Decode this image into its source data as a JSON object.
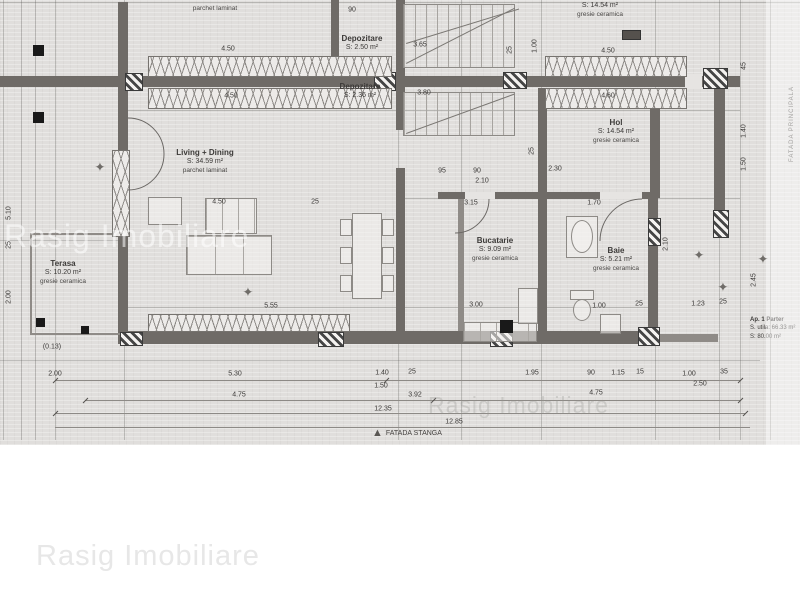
{
  "watermark": {
    "text": "Rasig Imobiliare"
  },
  "plan": {
    "facade_main_label": "FATADA PRINCIPALA",
    "facade_left_label": "FATADA STANGA",
    "apartment": {
      "line1": "Ap. 1 Parter",
      "line2": "S. utila: 66.33 m²",
      "line3": "S: 80.00 m²"
    }
  },
  "glyphs": {
    "star": "✦",
    "triangle": "▲"
  },
  "rooms": [
    {
      "name": "Living + Dining",
      "area": "S: 34.59 m²",
      "finish": "parchet laminat",
      "x": 205,
      "y": 148
    },
    {
      "name": "Bucatarie",
      "area": "S: 9.09 m²",
      "finish": "gresie ceramica",
      "x": 495,
      "y": 236
    },
    {
      "name": "Baie",
      "area": "S: 5.21 m²",
      "finish": "gresie ceramica",
      "x": 616,
      "y": 246
    },
    {
      "name": "Hol",
      "area": "S: 14.54 m²",
      "finish": "gresie ceramica",
      "x": 616,
      "y": 118
    },
    {
      "name": "Terasa",
      "area": "S: 10.20 m²",
      "finish": "gresie ceramica",
      "x": 63,
      "y": 259
    },
    {
      "name": "Depozitare",
      "area": "S: 2.50 m²",
      "finish": "",
      "x": 362,
      "y": 34
    },
    {
      "name": "Depozitare",
      "area": "S: 2.36 m²",
      "finish": "",
      "x": 360,
      "y": 82
    },
    {
      "name": "",
      "area": "S: 14.54 m²",
      "finish": "gresie ceramica",
      "x": 600,
      "y": 2
    },
    {
      "name": "",
      "area": "",
      "finish": "parchet laminat",
      "x": 215,
      "y": 5
    }
  ],
  "dimensions": [
    {
      "t": "4.50",
      "x": 228,
      "y": 49
    },
    {
      "t": "4.50",
      "x": 231,
      "y": 96
    },
    {
      "t": "4.50",
      "x": 608,
      "y": 51
    },
    {
      "t": "4.60",
      "x": 608,
      "y": 96
    },
    {
      "t": "3.65",
      "x": 420,
      "y": 45
    },
    {
      "t": "3.80",
      "x": 424,
      "y": 93
    },
    {
      "t": "90",
      "x": 352,
      "y": 10
    },
    {
      "t": "25",
      "x": 510,
      "y": 50,
      "r": -90
    },
    {
      "t": "1.00",
      "x": 535,
      "y": 46,
      "r": -90
    },
    {
      "t": "95",
      "x": 442,
      "y": 171
    },
    {
      "t": "90",
      "x": 477,
      "y": 171
    },
    {
      "t": "2.10",
      "x": 482,
      "y": 181
    },
    {
      "t": "2.30",
      "x": 555,
      "y": 169
    },
    {
      "t": "25",
      "x": 532,
      "y": 151,
      "r": -90
    },
    {
      "t": "4.50",
      "x": 219,
      "y": 202
    },
    {
      "t": "25",
      "x": 315,
      "y": 202
    },
    {
      "t": "3.15",
      "x": 471,
      "y": 203
    },
    {
      "t": "1.70",
      "x": 594,
      "y": 203
    },
    {
      "t": "2.10",
      "x": 666,
      "y": 244,
      "r": -90
    },
    {
      "t": "2.45",
      "x": 754,
      "y": 280,
      "r": -90
    },
    {
      "t": "1.23",
      "x": 698,
      "y": 304
    },
    {
      "t": "25",
      "x": 723,
      "y": 302
    },
    {
      "t": "5.55",
      "x": 271,
      "y": 306
    },
    {
      "t": "3.00",
      "x": 476,
      "y": 305
    },
    {
      "t": "1.00",
      "x": 599,
      "y": 306
    },
    {
      "t": "25",
      "x": 639,
      "y": 304
    },
    {
      "t": "5.10",
      "x": 9,
      "y": 213,
      "r": -90
    },
    {
      "t": "25",
      "x": 9,
      "y": 245,
      "r": -90
    },
    {
      "t": "2.00",
      "x": 9,
      "y": 297,
      "r": -90
    },
    {
      "t": "(0.13)",
      "x": 52,
      "y": 347
    },
    {
      "t": "2.00",
      "x": 55,
      "y": 374
    },
    {
      "t": "5.30",
      "x": 235,
      "y": 374
    },
    {
      "t": "1.40",
      "x": 382,
      "y": 373
    },
    {
      "t": "25",
      "x": 412,
      "y": 372
    },
    {
      "t": "1.50",
      "x": 381,
      "y": 386
    },
    {
      "t": "1.95",
      "x": 532,
      "y": 373
    },
    {
      "t": "90",
      "x": 591,
      "y": 373
    },
    {
      "t": "1.15",
      "x": 618,
      "y": 373
    },
    {
      "t": "15",
      "x": 640,
      "y": 372
    },
    {
      "t": "1.00",
      "x": 689,
      "y": 374
    },
    {
      "t": "35",
      "x": 724,
      "y": 372
    },
    {
      "t": "2.50",
      "x": 700,
      "y": 384
    },
    {
      "t": "4.75",
      "x": 239,
      "y": 395
    },
    {
      "t": "3.92",
      "x": 415,
      "y": 395
    },
    {
      "t": "4.75",
      "x": 596,
      "y": 393
    },
    {
      "t": "12.35",
      "x": 383,
      "y": 409
    },
    {
      "t": "12.85",
      "x": 454,
      "y": 422
    },
    {
      "t": "45",
      "x": 744,
      "y": 66,
      "r": -90
    },
    {
      "t": "1.40",
      "x": 744,
      "y": 131,
      "r": -90
    },
    {
      "t": "1.50",
      "x": 744,
      "y": 164,
      "r": -90
    }
  ],
  "symbols": [
    {
      "x": 100,
      "y": 167
    },
    {
      "x": 248,
      "y": 292
    },
    {
      "x": 699,
      "y": 255
    },
    {
      "x": 763,
      "y": 259
    },
    {
      "x": 723,
      "y": 287
    }
  ]
}
